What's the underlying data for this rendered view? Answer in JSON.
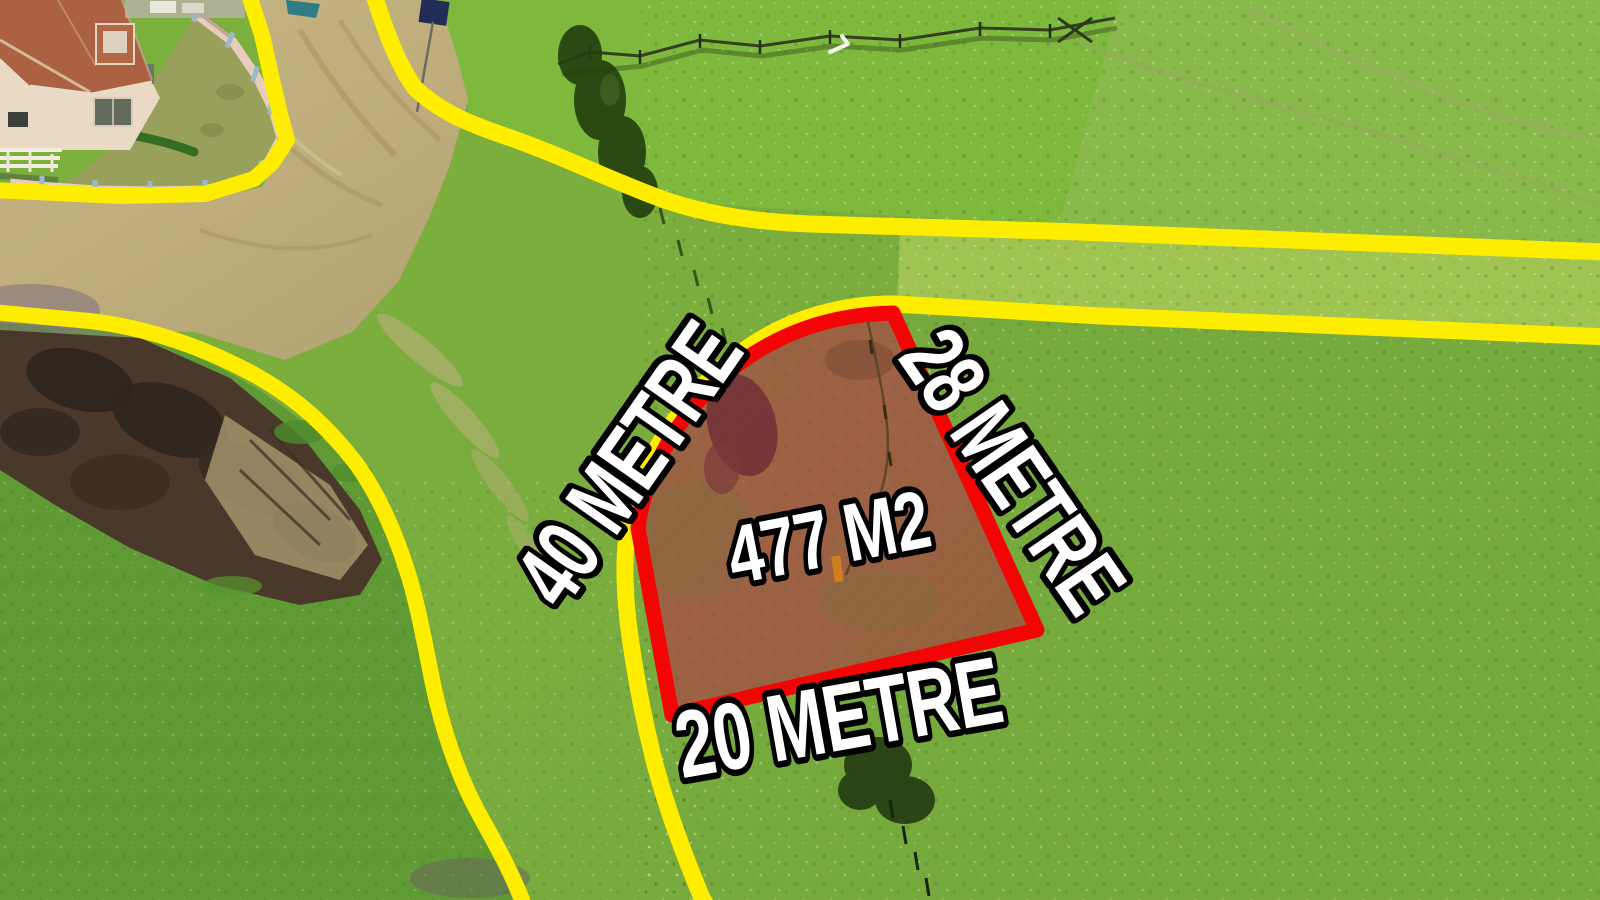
{
  "plot": {
    "area_label": "477 M2",
    "side_west_label": "40 METRE",
    "side_east_label": "28 METRE",
    "side_south_label": "20 METRE",
    "outline_color": "#f40505"
  },
  "boundaries": {
    "line_color": "#ffed00"
  },
  "label_style": {
    "fill": "#ffffff",
    "outline": "#000000"
  }
}
